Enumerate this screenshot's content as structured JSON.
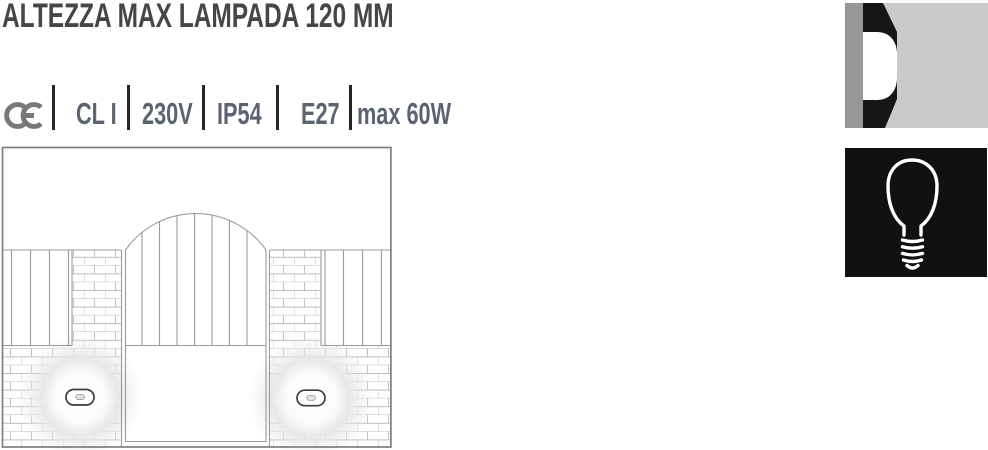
{
  "header": {
    "title": "ALTEZZA MAX LAMPADA 120 MM"
  },
  "specs": {
    "ce_label": "CE",
    "items": [
      {
        "label": "CL I"
      },
      {
        "label": "230V"
      },
      {
        "label": "IP54"
      },
      {
        "label": "E27"
      },
      {
        "label": "max 60W"
      }
    ]
  },
  "icons": {
    "ce": "ce-mark-icon",
    "beam": "recessed-wall-light-beam-icon",
    "bulb": "e27-light-bulb-icon"
  },
  "drawing": {
    "description": "installation-drawing-garden-wall-gate-with-two-recessed-ground-lights"
  },
  "colors": {
    "title_text": "#45454a",
    "spec_text": "#5c6370",
    "separator": "#26262a",
    "icon_wall_gray": "#97989a",
    "icon_black": "#161618",
    "icon_beam_gray": "#c9cacc",
    "drawing_line": "#9b9b9d"
  }
}
